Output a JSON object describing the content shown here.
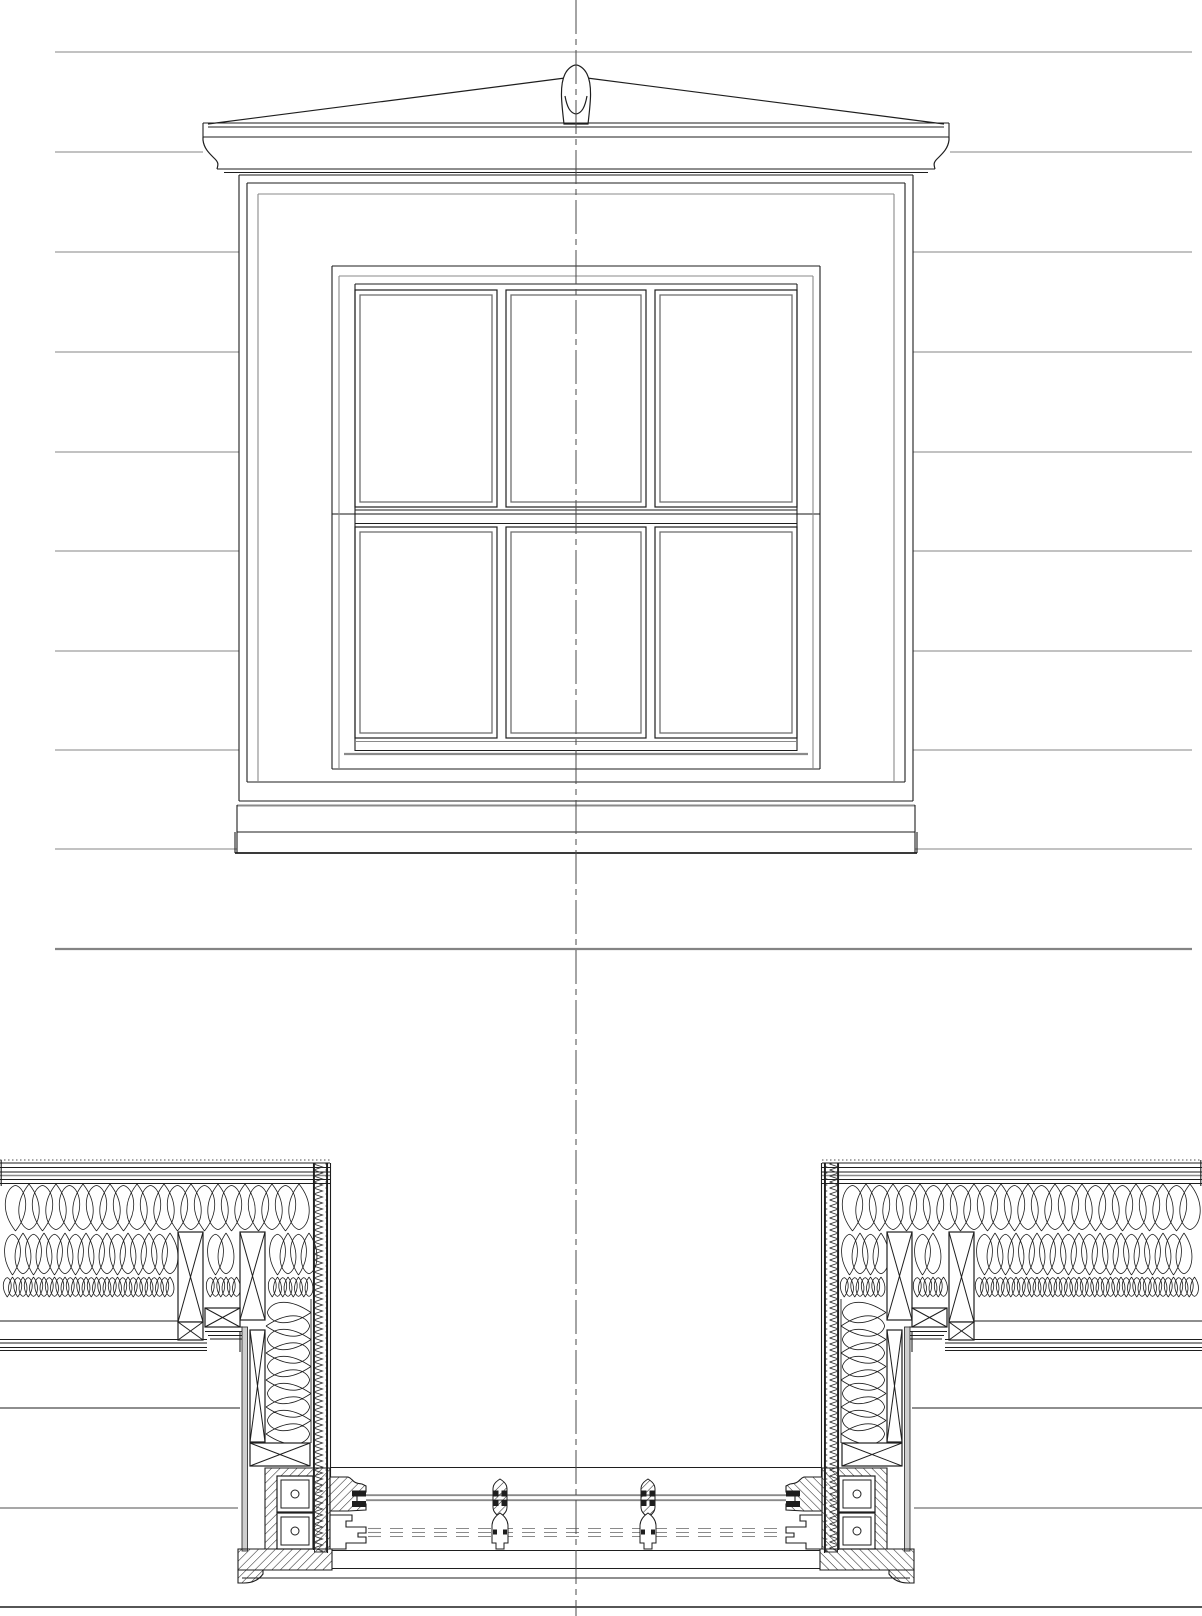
{
  "canvas": {
    "width": 1202,
    "height": 1616,
    "background": "#ffffff"
  },
  "colors": {
    "ink": "#1e1e1e",
    "gray": "#8a8a8a",
    "soft": "#6f6f6f",
    "paper": "#ffffff",
    "gypsum": "#cfcfcf",
    "dash_gray": "#9a9a9a",
    "siding": "#848484",
    "center": "#4a4a4a"
  },
  "centerline": {
    "x": 576,
    "y1": 0,
    "y2": 1616,
    "dash": "34 5 6 5",
    "w": 1
  },
  "siding": {
    "w": 1.1,
    "lines": [
      {
        "y": 52,
        "seg": [
          [
            55,
            1192
          ]
        ]
      },
      {
        "y": 152,
        "seg": [
          [
            55,
            203
          ],
          [
            950,
            1192
          ]
        ]
      },
      {
        "y": 252,
        "seg": [
          [
            55,
            239
          ],
          [
            913,
            1192
          ]
        ]
      },
      {
        "y": 352,
        "seg": [
          [
            55,
            239
          ],
          [
            913,
            1192
          ]
        ]
      },
      {
        "y": 452,
        "seg": [
          [
            55,
            239
          ],
          [
            913,
            1192
          ]
        ]
      },
      {
        "y": 551,
        "seg": [
          [
            55,
            239
          ],
          [
            913,
            1192
          ]
        ]
      },
      {
        "y": 651,
        "seg": [
          [
            55,
            239
          ],
          [
            913,
            1192
          ]
        ]
      },
      {
        "y": 750,
        "seg": [
          [
            55,
            239
          ],
          [
            913,
            1192
          ]
        ]
      },
      {
        "y": 849,
        "seg": [
          [
            55,
            237
          ],
          [
            915,
            1192
          ]
        ]
      },
      {
        "y": 949,
        "seg": [
          [
            55,
            1192
          ]
        ],
        "w": 2.2
      }
    ]
  },
  "elevation": {
    "pediment_paths": [
      {
        "d": "M208,124 L565,78",
        "f": "none"
      },
      {
        "d": "M587,78 L944,124",
        "f": "none"
      },
      {
        "d": "M564,124 C562,106 559,86 565,74 C568,68 573,65 576,65 C579,65 584,68 587,74 C593,86 590,106 588,124 Z",
        "f": "paper"
      },
      {
        "d": "M565,96 C567,107 570,113 576,114 C582,113 585,107 587,96",
        "f": "none"
      },
      {
        "d": "M203,137 L203,140 C204,149 210,154 215,159 C219,163 218,165 217,169",
        "f": "none"
      },
      {
        "d": "M949,137 L949,140 C948,149 942,154 937,159 C933,163 934,165 935,169",
        "f": "none"
      }
    ],
    "hlines": [
      {
        "y": 123,
        "x": [
          203,
          949
        ]
      },
      {
        "y": 127,
        "x": [
          208,
          944
        ]
      },
      {
        "y": 137,
        "x": [
          203,
          949
        ]
      },
      {
        "y": 169,
        "x": [
          217,
          935
        ]
      },
      {
        "y": 172.5,
        "x": [
          224,
          928
        ],
        "w": 0.9
      },
      {
        "y": 175,
        "x": [
          239,
          913
        ]
      },
      {
        "y": 183,
        "x": [
          247,
          905
        ]
      },
      {
        "y": 194,
        "x": [
          258,
          894
        ],
        "c": "gray"
      },
      {
        "y": 266,
        "x": [
          332,
          820
        ]
      },
      {
        "y": 276,
        "x": [
          339,
          813
        ],
        "c": "gray"
      },
      {
        "y": 284,
        "x": [
          355,
          797
        ]
      },
      {
        "y": 510,
        "x": [
          355,
          797
        ]
      },
      {
        "y": 514,
        "x": [
          332,
          820
        ],
        "c": "gray",
        "w": 2
      },
      {
        "y": 523.5,
        "x": [
          355,
          797
        ]
      },
      {
        "y": 741.5,
        "x": [
          356,
          796
        ],
        "c": "gray"
      },
      {
        "y": 750.5,
        "x": [
          355,
          797
        ]
      },
      {
        "y": 754,
        "x": [
          344,
          808
        ],
        "c": "gray",
        "w": 2.2
      },
      {
        "y": 769,
        "x": [
          332,
          820
        ]
      },
      {
        "y": 782,
        "x": [
          247,
          905
        ]
      },
      {
        "y": 801,
        "x": [
          239,
          913
        ]
      },
      {
        "y": 805.5,
        "x": [
          237,
          915
        ],
        "c": "gray",
        "w": 2
      },
      {
        "y": 832,
        "x": [
          237,
          915
        ]
      },
      {
        "y": 853,
        "x": [
          235,
          917
        ],
        "w": 1.8
      }
    ],
    "vlines": [
      {
        "x": 203,
        "y": [
          123,
          137
        ]
      },
      {
        "x": 949,
        "y": [
          123,
          137
        ]
      },
      {
        "x": 239,
        "y": [
          175,
          801
        ]
      },
      {
        "x": 913,
        "y": [
          175,
          801
        ]
      },
      {
        "x": 247,
        "y": [
          183,
          782
        ]
      },
      {
        "x": 905,
        "y": [
          183,
          782
        ]
      },
      {
        "x": 258,
        "y": [
          194,
          782
        ],
        "c": "gray"
      },
      {
        "x": 894,
        "y": [
          194,
          782
        ],
        "c": "gray"
      },
      {
        "x": 332,
        "y": [
          266,
          769
        ]
      },
      {
        "x": 820,
        "y": [
          266,
          769
        ]
      },
      {
        "x": 339,
        "y": [
          276,
          769
        ],
        "c": "gray"
      },
      {
        "x": 813,
        "y": [
          276,
          769
        ],
        "c": "gray"
      },
      {
        "x": 355,
        "y": [
          284,
          751
        ]
      },
      {
        "x": 797,
        "y": [
          284,
          751
        ]
      },
      {
        "x": 237,
        "y": [
          805,
          853
        ]
      },
      {
        "x": 915,
        "y": [
          805,
          853
        ]
      },
      {
        "x": 235,
        "y": [
          832,
          853
        ]
      },
      {
        "x": 917,
        "y": [
          832,
          853
        ]
      }
    ],
    "panes": {
      "inset": 5,
      "upper": [
        [
          355,
          290,
          142,
          217
        ],
        [
          506,
          290,
          140,
          217
        ],
        [
          655,
          290,
          142,
          217
        ]
      ],
      "lower": [
        [
          355,
          527,
          142,
          211
        ],
        [
          506,
          527,
          140,
          211
        ],
        [
          655,
          527,
          142,
          211
        ]
      ]
    }
  },
  "section": {
    "band": {
      "segs": [
        [
          0,
          330
        ],
        [
          822,
          1202
        ]
      ],
      "ys": [
        1163,
        1167.5,
        1172,
        1179.5,
        1183.5
      ],
      "gray_y": 1175.5,
      "tick_y": 1160
    },
    "hlines": [
      {
        "y": 1321,
        "x": [
          0,
          178
        ]
      },
      {
        "y": 1321,
        "x": [
          974,
          1202
        ]
      },
      {
        "y": 1339.5,
        "x": [
          0,
          207
        ]
      },
      {
        "y": 1343,
        "x": [
          0,
          207
        ]
      },
      {
        "y": 1339.5,
        "x": [
          945,
          1202
        ]
      },
      {
        "y": 1343,
        "x": [
          945,
          1202
        ]
      },
      {
        "y": 1347.5,
        "x": [
          0,
          207
        ]
      },
      {
        "y": 1350.5,
        "x": [
          0,
          207
        ]
      },
      {
        "y": 1347.5,
        "x": [
          945,
          1202
        ]
      },
      {
        "y": 1350.5,
        "x": [
          945,
          1202
        ]
      },
      {
        "y": 1327,
        "x": [
          205,
          243
        ]
      },
      {
        "y": 1331.5,
        "x": [
          205,
          243
        ]
      },
      {
        "y": 1335.5,
        "x": [
          208,
          243
        ]
      },
      {
        "y": 1339,
        "x": [
          210,
          243
        ]
      },
      {
        "y": 1327,
        "x": [
          909,
          947
        ]
      },
      {
        "y": 1331.5,
        "x": [
          909,
          947
        ]
      },
      {
        "y": 1335.5,
        "x": [
          909,
          944
        ]
      },
      {
        "y": 1339,
        "x": [
          909,
          942
        ]
      },
      {
        "y": 1408,
        "x": [
          0,
          240
        ]
      },
      {
        "y": 1408,
        "x": [
          912,
          1202
        ]
      },
      {
        "y": 1467.5,
        "x": [
          331,
          821
        ]
      },
      {
        "y": 1508,
        "x": [
          0,
          238
        ],
        "c": "gray",
        "w": 1.6
      },
      {
        "y": 1508,
        "x": [
          914,
          1202
        ],
        "c": "gray",
        "w": 1.6
      },
      {
        "y": 1550.5,
        "x": [
          332,
          820
        ]
      },
      {
        "y": 1568.5,
        "x": [
          332,
          820
        ]
      },
      {
        "y": 1578,
        "x": [
          242,
          910
        ]
      },
      {
        "y": 1607,
        "x": [
          0,
          1202
        ],
        "w": 1.5
      }
    ],
    "vlines": [
      {
        "x": 313.5,
        "y": [
          1163,
          1550
        ]
      },
      {
        "x": 838.5,
        "y": [
          1163,
          1550
        ]
      },
      {
        "x": 327.5,
        "y": [
          1163,
          1553
        ]
      },
      {
        "x": 824.5,
        "y": [
          1163,
          1553
        ]
      },
      {
        "x": 330.5,
        "y": [
          1163,
          1477
        ]
      },
      {
        "x": 821.5,
        "y": [
          1163,
          1477
        ]
      },
      {
        "x": 240,
        "y": [
          1331,
          1352
        ]
      },
      {
        "x": 912,
        "y": [
          1331,
          1352
        ]
      },
      {
        "x": 243.5,
        "y": [
          1339,
          1356
        ]
      },
      {
        "x": 908.5,
        "y": [
          1339,
          1356
        ]
      },
      {
        "x": 311,
        "y": [
          1299,
          1443
        ],
        "w": 0.9
      },
      {
        "x": 841,
        "y": [
          1299,
          1443
        ],
        "w": 0.9
      },
      {
        "x": 1.2,
        "y": [
          1160,
          1186
        ]
      },
      {
        "x": 1200.8,
        "y": [
          1160,
          1186
        ]
      }
    ],
    "zigzag": [
      [
        314.5,
        1163,
        12,
        389
      ],
      [
        825.5,
        1163,
        12,
        389
      ]
    ],
    "studs": [
      [
        178,
        1232,
        25,
        90
      ],
      [
        240,
        1232,
        25,
        88
      ],
      [
        205,
        1308,
        35,
        19
      ],
      [
        178,
        1322,
        25,
        18
      ],
      [
        250,
        1330,
        15,
        112
      ],
      [
        250,
        1443,
        60,
        23
      ],
      [
        949,
        1232,
        25,
        90
      ],
      [
        887,
        1232,
        25,
        88
      ],
      [
        912,
        1308,
        35,
        19
      ],
      [
        949,
        1322,
        25,
        18
      ],
      [
        887,
        1330,
        15,
        112
      ],
      [
        842,
        1443,
        60,
        23
      ]
    ],
    "gypsum": [
      [
        242,
        1327,
        5.5,
        224
      ],
      [
        904.5,
        1327,
        5.5,
        224
      ]
    ],
    "ins_rows": [
      {
        "y": 1184,
        "h": 47,
        "unit": 27,
        "seg": [
          [
            2,
            313
          ],
          [
            839,
            1200
          ]
        ]
      },
      {
        "y": 1233,
        "h": 42,
        "unit": 21,
        "seg": [
          [
            2,
            178
          ],
          [
            205,
            240
          ],
          [
            267,
            313
          ],
          [
            839,
            885
          ],
          [
            912,
            947
          ],
          [
            974,
            1200
          ]
        ]
      },
      {
        "y": 1277,
        "h": 20,
        "unit": 10.5,
        "seg": [
          [
            2,
            178
          ],
          [
            205,
            240
          ],
          [
            267,
            313
          ],
          [
            839,
            885
          ],
          [
            912,
            947
          ],
          [
            974,
            1200
          ]
        ]
      }
    ],
    "ins_cols": [
      {
        "x": 266,
        "w": 45,
        "unit": 27,
        "y": [
          1299,
          1441
        ]
      },
      {
        "x": 841,
        "w": 45,
        "unit": 27,
        "y": [
          1299,
          1441
        ]
      }
    ],
    "jamb": {
      "mirror_x": 1152,
      "paths": [
        {
          "d": "M265,1468 L330,1468 L330,1549 L265,1549 Z",
          "f": "hatch"
        },
        {
          "d": "M238,1549 L332,1549 L332,1570 L238,1570 Z",
          "f": "hatch"
        },
        {
          "d": "M238,1570 L263,1570 L263,1574 C258,1581 251,1583 244,1583 L238,1583 Z",
          "f": "hatch"
        },
        {
          "d": "M330,1477 L348,1477 C354,1479 351,1483 362,1484 L366,1486 L366,1492 L357,1493 L357,1503 L366,1504 L366,1510 L348,1511 L330,1511 Z",
          "f": "hatch"
        },
        {
          "d": "M330,1515 L352,1515 L352,1521 L346,1521 L346,1527 L366,1527 L366,1533 L358,1533 L358,1537 L366,1537 L366,1543 L346,1543 L346,1549 L330,1549 Z",
          "f": "paper"
        }
      ],
      "squares": [
        [
          277,
          1476,
          36,
          36
        ],
        [
          277,
          1513,
          36,
          36
        ]
      ],
      "square_inset": 4,
      "circles": [
        [
          295,
          1494,
          4
        ],
        [
          295,
          1531,
          4
        ]
      ]
    },
    "glass": {
      "ys": [
        1495.2,
        1500.2
      ],
      "x": [
        366,
        786
      ],
      "w": 1.9
    },
    "stile_stops": [
      [
        352,
        1490.5,
        14,
        6
      ],
      [
        352,
        1501,
        14,
        6
      ],
      [
        786,
        1490.5,
        14,
        6
      ],
      [
        786,
        1501,
        14,
        6
      ]
    ],
    "dashed": {
      "ys": [
        1528.5,
        1532.5,
        1536.5
      ],
      "x": [
        368,
        784
      ],
      "dash": "13 9",
      "w": 1.1
    },
    "muntins_solid": [
      500,
      648
    ],
    "muntins_dashed": [
      500,
      648
    ]
  }
}
